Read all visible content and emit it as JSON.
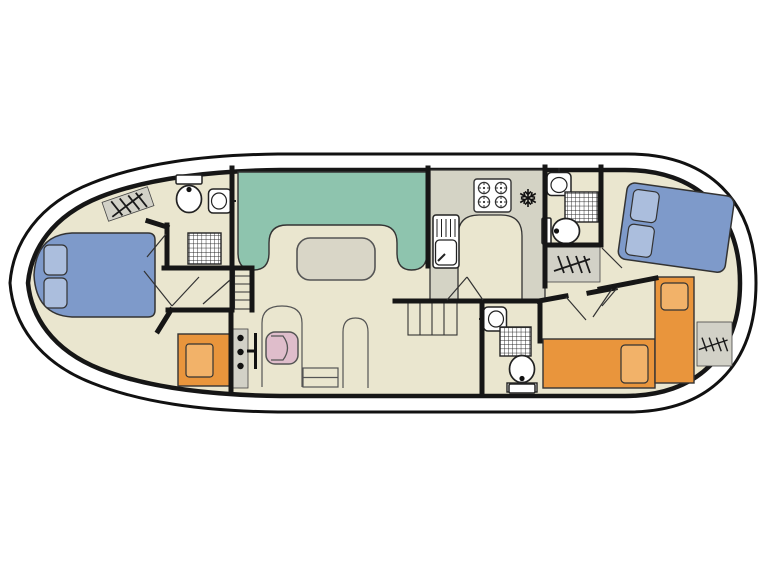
{
  "title": "Boat deck plan — interior layout (bow left, stern right)",
  "diagram_type": "floor-plan",
  "colors": {
    "background": "#ffffff",
    "floor": "#eae6cf",
    "wall": "#161616",
    "outline": "#333333",
    "bed": "#7e9aca",
    "bed_pillow": "#abbedd",
    "dinette": "#8ec4ae",
    "table": "#d9d6c7",
    "counter": "#d4d3c5",
    "berth_orange": "#e9953c",
    "berth_pillow": "#f2b269",
    "helm_seat": "#dfbdcb",
    "radiator": "#d2d1c7",
    "fixture": "#ffffff"
  },
  "rooms": [
    {
      "id": "bow-cabin",
      "fixtures": [
        "double-bed",
        "pillows",
        "wardrobe"
      ]
    },
    {
      "id": "bow-bathroom",
      "fixtures": [
        "toilet",
        "washbasin",
        "shower",
        "radiator"
      ]
    },
    {
      "id": "saloon",
      "fixtures": [
        "u-dinette",
        "table",
        "helm-panel",
        "steering-wheel",
        "helm-seat",
        "step"
      ]
    },
    {
      "id": "galley",
      "fixtures": [
        "u-counter",
        "hob-4-burners",
        "sink-with-drainer",
        "fridge-snowflake"
      ]
    },
    {
      "id": "mid-bathroom",
      "fixtures": [
        "washbasin",
        "shower",
        "toilet",
        "radiator"
      ]
    },
    {
      "id": "aft-bathroom",
      "fixtures": [
        "washbasin",
        "shower",
        "toilet"
      ]
    },
    {
      "id": "stern-cabin",
      "fixtures": [
        "double-bed",
        "pillows",
        "single-berth",
        "single-berth",
        "radiator"
      ]
    },
    {
      "id": "companionways",
      "fixtures": [
        "bow-steps",
        "mid-stairs"
      ]
    }
  ]
}
